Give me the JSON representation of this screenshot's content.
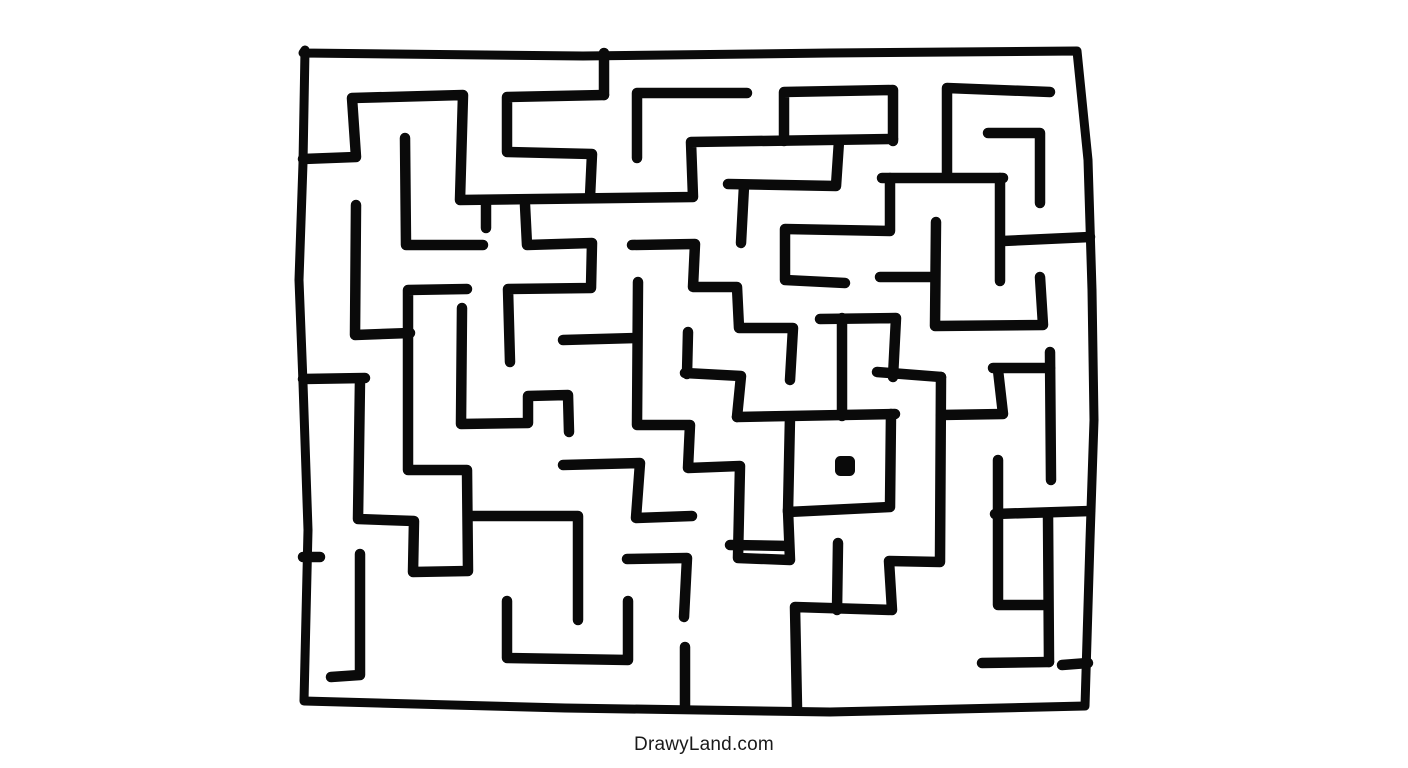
{
  "site": {
    "watermark": "DrawyLand.com"
  },
  "canvas": {
    "width": 1408,
    "height": 768,
    "background": "#ffffff"
  },
  "maze": {
    "stroke_color": "#0a0a0a",
    "stroke_width": 10.5,
    "border_stroke_width": 9,
    "border": [
      [
        305,
        50
      ],
      [
        303,
        163
      ],
      [
        299,
        280
      ],
      [
        303,
        383
      ],
      [
        308,
        530
      ],
      [
        304,
        701
      ],
      [
        565,
        708
      ],
      [
        830,
        712
      ],
      [
        1085,
        706
      ],
      [
        1090,
        540
      ],
      [
        1094,
        420
      ],
      [
        1092,
        290
      ],
      [
        1088,
        160
      ],
      [
        1077,
        51
      ],
      [
        830,
        53
      ],
      [
        583,
        56
      ],
      [
        303,
        53
      ]
    ],
    "walls": [
      [
        [
          303,
          159
        ],
        [
          356,
          157
        ],
        [
          352,
          98
        ],
        [
          463,
          95
        ],
        [
          460,
          200
        ],
        [
          693,
          197
        ],
        [
          691,
          142
        ],
        [
          893,
          139
        ]
      ],
      [
        [
          784,
          141
        ],
        [
          784,
          92
        ],
        [
          893,
          90
        ],
        [
          893,
          141
        ]
      ],
      [
        [
          839,
          141
        ],
        [
          836,
          186
        ],
        [
          728,
          184
        ]
      ],
      [
        [
          744,
          186
        ],
        [
          741,
          243
        ]
      ],
      [
        [
          604,
          53
        ],
        [
          604,
          95
        ]
      ],
      [
        [
          604,
          95
        ],
        [
          507,
          97
        ],
        [
          507,
          152
        ],
        [
          592,
          154
        ],
        [
          590,
          197
        ]
      ],
      [
        [
          637,
          158
        ],
        [
          637,
          93
        ],
        [
          747,
          93
        ]
      ],
      [
        [
          947,
          175
        ],
        [
          947,
          88
        ],
        [
          1050,
          92
        ]
      ],
      [
        [
          882,
          178
        ],
        [
          1003,
          178
        ]
      ],
      [
        [
          1000,
          178
        ],
        [
          1000,
          281
        ]
      ],
      [
        [
          890,
          178
        ],
        [
          890,
          231
        ],
        [
          785,
          229
        ],
        [
          785,
          280
        ],
        [
          845,
          283
        ]
      ],
      [
        [
          988,
          133
        ],
        [
          1040,
          133
        ],
        [
          1040,
          203
        ]
      ],
      [
        [
          1003,
          241
        ],
        [
          1090,
          237
        ]
      ],
      [
        [
          405,
          138
        ],
        [
          406,
          245
        ],
        [
          483,
          245
        ]
      ],
      [
        [
          525,
          205
        ],
        [
          527,
          245
        ],
        [
          592,
          243
        ],
        [
          591,
          288
        ],
        [
          508,
          289
        ],
        [
          510,
          362
        ]
      ],
      [
        [
          486,
          202
        ],
        [
          486,
          228
        ]
      ],
      [
        [
          356,
          205
        ],
        [
          355,
          335
        ],
        [
          410,
          333
        ]
      ],
      [
        [
          360,
          380
        ],
        [
          358,
          519
        ],
        [
          414,
          521
        ],
        [
          413,
          572
        ],
        [
          468,
          571
        ],
        [
          467,
          470
        ],
        [
          408,
          470
        ],
        [
          408,
          290
        ],
        [
          467,
          289
        ]
      ],
      [
        [
          303,
          379
        ],
        [
          365,
          378
        ]
      ],
      [
        [
          470,
          516
        ],
        [
          578,
          516
        ],
        [
          578,
          620
        ]
      ],
      [
        [
          462,
          308
        ],
        [
          461,
          424
        ],
        [
          528,
          423
        ],
        [
          528,
          396
        ],
        [
          568,
          395
        ],
        [
          569,
          432
        ]
      ],
      [
        [
          563,
          340
        ],
        [
          636,
          338
        ]
      ],
      [
        [
          638,
          282
        ],
        [
          637,
          425
        ],
        [
          690,
          425
        ],
        [
          688,
          468
        ],
        [
          740,
          466
        ],
        [
          738,
          558
        ],
        [
          790,
          560
        ],
        [
          788,
          510
        ]
      ],
      [
        [
          730,
          545
        ],
        [
          789,
          546
        ]
      ],
      [
        [
          688,
          332
        ],
        [
          687,
          374
        ]
      ],
      [
        [
          685,
          373
        ],
        [
          741,
          376
        ],
        [
          737,
          417
        ]
      ],
      [
        [
          737,
          417
        ],
        [
          895,
          414
        ]
      ],
      [
        [
          842,
          318
        ],
        [
          842,
          416
        ]
      ],
      [
        [
          790,
          417
        ],
        [
          788,
          512
        ],
        [
          890,
          507
        ],
        [
          891,
          414
        ]
      ],
      [
        [
          632,
          245
        ],
        [
          695,
          244
        ],
        [
          693,
          287
        ],
        [
          737,
          287
        ],
        [
          739,
          328
        ],
        [
          793,
          328
        ],
        [
          790,
          380
        ]
      ],
      [
        [
          820,
          319
        ],
        [
          896,
          318
        ],
        [
          893,
          377
        ]
      ],
      [
        [
          877,
          372
        ],
        [
          941,
          377
        ]
      ],
      [
        [
          941,
          377
        ],
        [
          940,
          562
        ],
        [
          889,
          561
        ],
        [
          892,
          610
        ],
        [
          795,
          607
        ],
        [
          797,
          708
        ]
      ],
      [
        [
          837,
          610
        ],
        [
          838,
          543
        ]
      ],
      [
        [
          941,
          415
        ],
        [
          1003,
          414
        ],
        [
          998,
          370
        ]
      ],
      [
        [
          993,
          368
        ],
        [
          1050,
          368
        ]
      ],
      [
        [
          1050,
          352
        ],
        [
          1051,
          480
        ]
      ],
      [
        [
          995,
          514
        ],
        [
          1090,
          511
        ]
      ],
      [
        [
          998,
          460
        ],
        [
          998,
          605
        ],
        [
          1048,
          605
        ]
      ],
      [
        [
          1048,
          514
        ],
        [
          1049,
          662
        ]
      ],
      [
        [
          982,
          663
        ],
        [
          1049,
          662
        ]
      ],
      [
        [
          1062,
          665
        ],
        [
          1088,
          663
        ]
      ],
      [
        [
          880,
          277
        ],
        [
          933,
          277
        ]
      ],
      [
        [
          936,
          222
        ],
        [
          935,
          326
        ],
        [
          1043,
          325
        ],
        [
          1040,
          277
        ]
      ],
      [
        [
          563,
          465
        ],
        [
          640,
          463
        ],
        [
          636,
          518
        ],
        [
          692,
          516
        ]
      ],
      [
        [
          627,
          559
        ],
        [
          687,
          558
        ],
        [
          684,
          617
        ]
      ],
      [
        [
          685,
          647
        ],
        [
          685,
          708
        ]
      ],
      [
        [
          507,
          601
        ],
        [
          507,
          658
        ],
        [
          628,
          660
        ],
        [
          628,
          601
        ]
      ],
      [
        [
          360,
          554
        ],
        [
          360,
          675
        ],
        [
          331,
          677
        ]
      ],
      [
        [
          303,
          557
        ],
        [
          320,
          557
        ]
      ]
    ],
    "goal_dot": {
      "cx": 845,
      "cy": 466,
      "r": 10
    }
  }
}
